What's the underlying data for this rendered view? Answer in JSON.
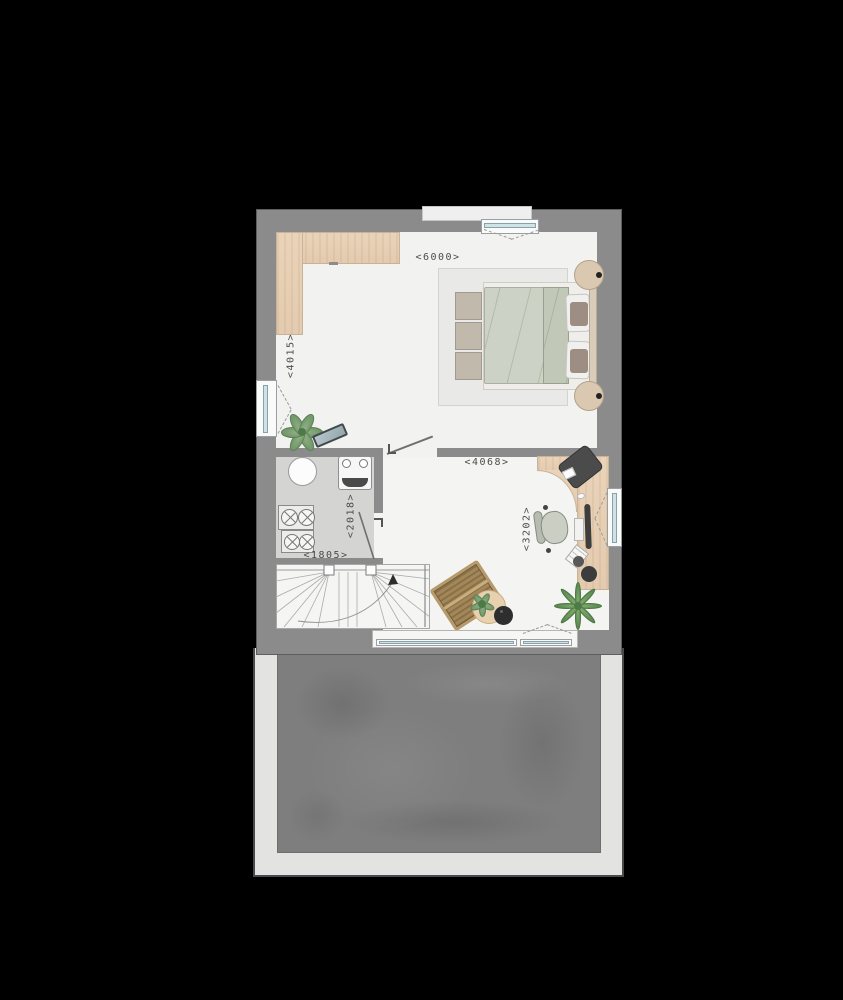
{
  "background": "#000000",
  "plan": {
    "dimensions": {
      "bedroom_width": "<6000>",
      "bedroom_depth": "<4015>",
      "study_width": "<4068>",
      "study_depth": "<3202>",
      "utility_width": "<1805>",
      "utility_depth": "<2018>"
    },
    "colors": {
      "wall": "#8b8b8b",
      "bedroom_floor": "#f2f2f0",
      "utility_floor": "#d4d4d2",
      "wood": "#e9d2b8",
      "window_glass": "#cfe2e6",
      "roof": "#7e7e7e",
      "roof_frame": "#e3e3e2",
      "dimension_text": "#4c4c4c",
      "plant_green": "#6d9466",
      "rattan": "#a98e5f",
      "duvet": "#ccd2c5"
    },
    "icons": [
      "wardrobe-icon",
      "double-bed-icon",
      "bed-bench-icon",
      "bedside-lamp-icon",
      "rug",
      "plant-icon",
      "bench-icon",
      "boiler-icon",
      "ventilation-unit-icon",
      "washing-machine-icon",
      "dryer-icon",
      "stairs-icon",
      "door-icon",
      "window-icon",
      "desk-icon",
      "desk-chair-icon",
      "office-chair-icon",
      "monitor-icon",
      "keyboard-icon",
      "mouse-icon",
      "notepad-icon",
      "desk-lamp-icon",
      "lounge-chair-icon",
      "side-table-icon",
      "palm-plant-icon",
      "roof-terrace"
    ]
  }
}
